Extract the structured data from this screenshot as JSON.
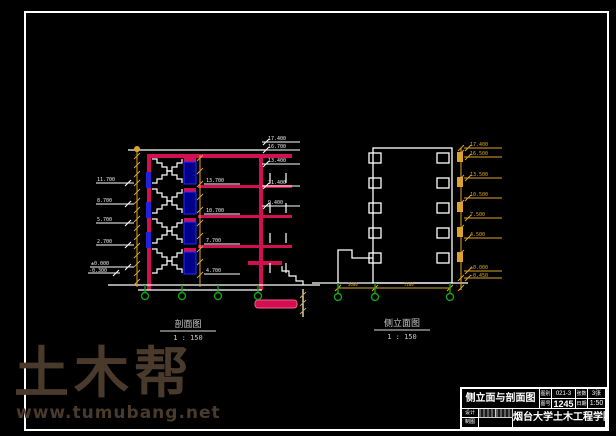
{
  "watermark": {
    "logo": "土木帮",
    "url": "www.tumubang.net"
  },
  "left_drawing": {
    "title": "剖面图",
    "scale": "1 : 150",
    "left_elevations": [
      "11.700",
      "8.700",
      "5.700",
      "2.700",
      "±0.000",
      "-0.300"
    ],
    "mid_elevations": [
      "13.700",
      "10.700",
      "7.700",
      "4.700"
    ],
    "right_elevations": [
      "17.400",
      "16.700",
      "13.400",
      "11.400",
      "9.400"
    ]
  },
  "right_drawing": {
    "title": "侧立面图",
    "scale": "1 : 150",
    "elevations": [
      "17.400",
      "16.500",
      "13.500",
      "10.500",
      "7.500",
      "4.500",
      "±0.000",
      "-0.450"
    ],
    "dims": [
      "3600",
      "7200"
    ]
  },
  "title_block": {
    "drawing_title": "侧立面与剖面图",
    "labels1": [
      "图别",
      "图号"
    ],
    "values1": [
      "021-3",
      "1245"
    ],
    "labels2": [
      "张数",
      "日期"
    ],
    "values2": [
      "3张",
      "1:50"
    ],
    "row2_labels": [
      "设计",
      "制图"
    ],
    "school": "烟台大学土木工程学院"
  },
  "colors": {
    "background": "#000000",
    "frame": "#ffffff",
    "slab_red": "#d01050",
    "window_blue": "#2222dd",
    "door_navy": "#00008b",
    "dim_yellow": "#dca32e",
    "grid_green": "#12a312",
    "watermark_brown": "#4a3a2b"
  }
}
